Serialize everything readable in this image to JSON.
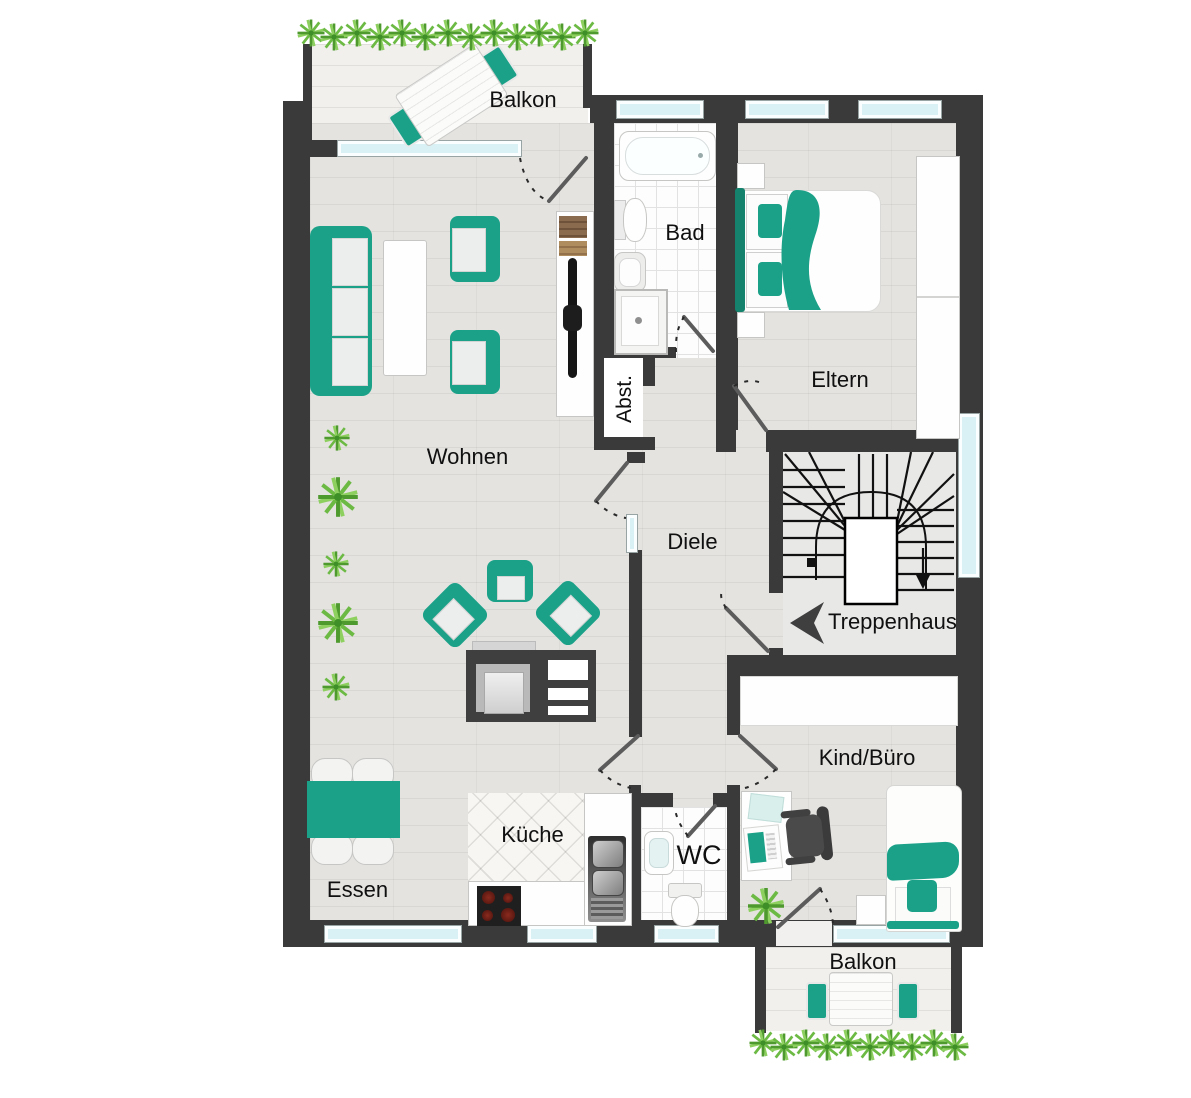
{
  "plan": {
    "title": "Wohnung Grundriss",
    "colors": {
      "accent_teal": "#1ba188",
      "wall": "#3a3a3a",
      "window_glass": "#d9f1f4",
      "plant_green": "#5fae3b",
      "floor_wood": "#e4e3e0",
      "background": "#ffffff"
    },
    "rooms": {
      "balkon_top": {
        "label": "Balkon"
      },
      "bad": {
        "label": "Bad"
      },
      "eltern": {
        "label": "Eltern"
      },
      "abstellraum": {
        "label": "Abst."
      },
      "wohnen": {
        "label": "Wohnen"
      },
      "diele": {
        "label": "Diele"
      },
      "treppenhaus": {
        "label": "Treppenhaus"
      },
      "kind_buero": {
        "label": "Kind/Büro"
      },
      "kueche": {
        "label": "Küche"
      },
      "wc": {
        "label": "WC"
      },
      "essen": {
        "label": "Essen"
      },
      "balkon_bottom": {
        "label": "Balkon"
      }
    }
  }
}
